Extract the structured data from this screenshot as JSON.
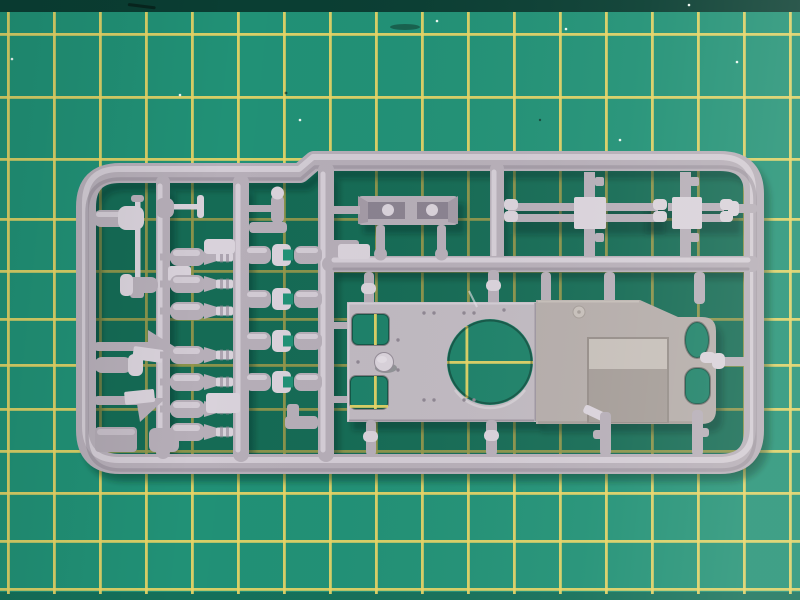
{
  "scene": {
    "type": "photograph",
    "description": "Light grey injection-moulded model kit sprue (parts tree) for a small military vehicle lying on a green self-healing cutting mat with yellow grid lines",
    "objects": {
      "cutting_mat": "green cutting mat with yellow grid, dark worn top edge",
      "sprue_frame": "rounded rectangular grey runner frame with stepped top rail",
      "hull_top_plate": "large flat deck plate with turret ring hole and two rectangular hatch openings",
      "engine_deck_plate": "second plate with recessed panel, oval opening and rounded cutout",
      "hull_tub_part": "small open trough part on upper runner",
      "axle_assemblies": "two cross-shaped axle/hub parts on upper right runner",
      "bottle_parts": "column of bottle-shaped parts (mufflers/dampers) on left runner",
      "clamp_parts": "column of paired cylinders with C-clamp brackets",
      "tool_parts": "small tools with triangular blades attached to left frame rail",
      "barrel_rod": "thin gun-barrel rod part",
      "corner_tab": "flat rectangular tab part in lower-left corner"
    }
  },
  "colors": {
    "mat": "#219176",
    "matEdge": "#0a3e33",
    "matBottom": "#15705a",
    "line": "#e8d565",
    "speck": "#eef7f2",
    "scuff": "#07251e",
    "plastic": "#b6aeb8",
    "plasticLight": "#d9d2db",
    "plasticDark": "#8e8692",
    "plate": "#c0b9c1",
    "plateLight": "#d3cdd5",
    "plateEdge": "#948c97",
    "rplate": "#b4acaa",
    "rplateLight": "#c6bfba",
    "rplateDark": "#a49c98",
    "holeGreen": "#1d8169",
    "shadow": "rgba(8,42,34,0.36)"
  },
  "grid": {
    "vertical_x": [
      7,
      53,
      99,
      145,
      191,
      237,
      283,
      329,
      375,
      421,
      467,
      513,
      559,
      605,
      651,
      697,
      743,
      789
    ],
    "horizontal_y": [
      33,
      96,
      158,
      218,
      270,
      318,
      364,
      408,
      450,
      492,
      540,
      588
    ],
    "line_width": 2.8,
    "top": 12,
    "bottom": 594
  },
  "parts": {
    "bottle_rows_y": [
      257,
      284,
      311,
      355,
      382,
      409,
      432
    ],
    "clamp_rows_y": [
      255,
      299,
      341,
      382
    ],
    "rivets": [
      [
        424,
        313
      ],
      [
        434,
        313
      ],
      [
        464,
        313
      ],
      [
        474,
        313
      ],
      [
        504,
        310
      ],
      [
        424,
        400
      ],
      [
        434,
        400
      ],
      [
        464,
        400
      ],
      [
        474,
        400
      ],
      [
        398,
        340
      ],
      [
        398,
        370
      ],
      [
        358,
        362
      ],
      [
        548,
        310
      ],
      [
        556,
        404
      ]
    ],
    "specks": [
      [
        566,
        29
      ],
      [
        689,
        5
      ],
      [
        737,
        62
      ],
      [
        180,
        95
      ],
      [
        12,
        59
      ],
      [
        437,
        21
      ],
      [
        620,
        140
      ],
      [
        300,
        120
      ]
    ]
  }
}
